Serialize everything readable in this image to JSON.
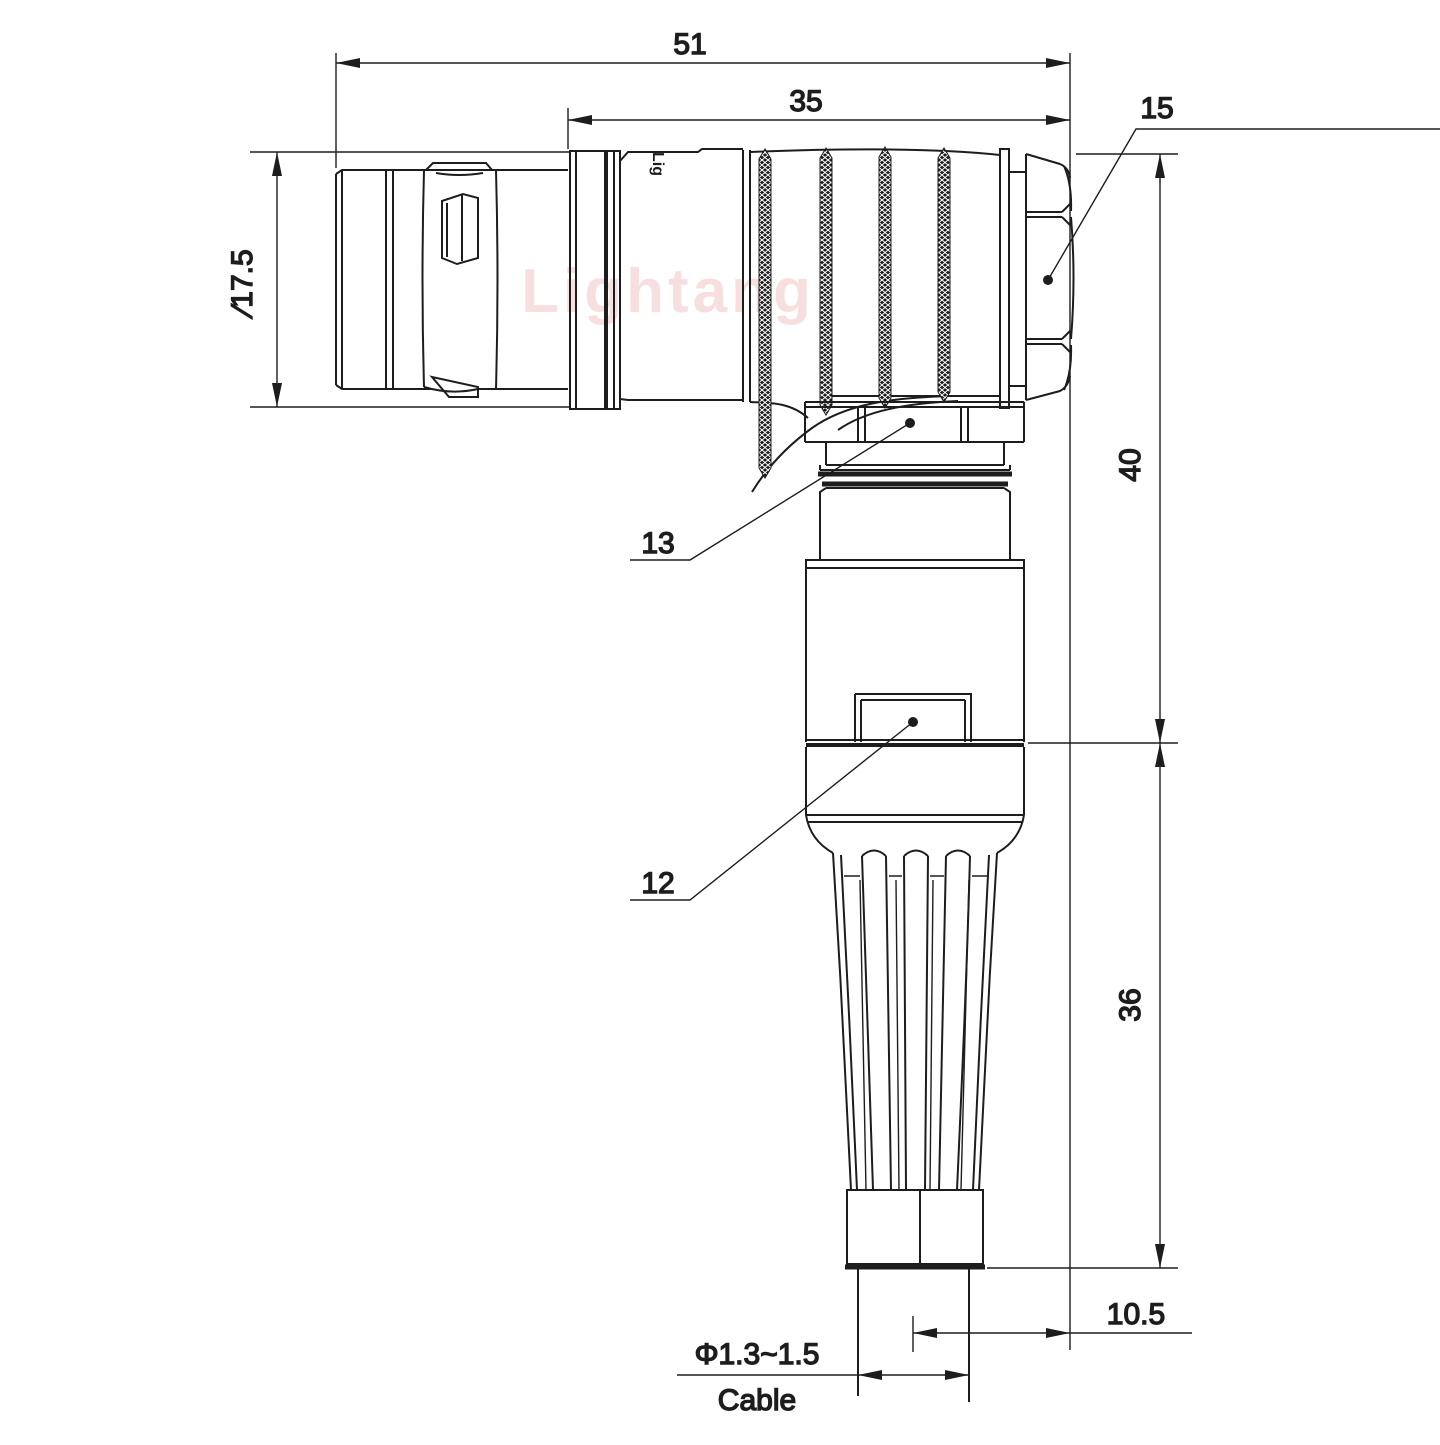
{
  "drawing": {
    "type": "technical-dimension-drawing",
    "line_color": "#1d1d1d",
    "watermark_color": "#f0b9b9",
    "watermark": "Lightang",
    "brand_mark": "Lig",
    "dimensions": {
      "overall_length": "51",
      "barrel_length": "35",
      "plug_diameter": "∕17.5",
      "upper_height": "40",
      "lower_height": "36",
      "axis_offset": "10.5",
      "cable_diameter": "Φ1.3~1.5",
      "cable_label": "Cable"
    },
    "part_labels": {
      "backnut": "15",
      "coupling_nut": "13",
      "housing": "12"
    }
  }
}
